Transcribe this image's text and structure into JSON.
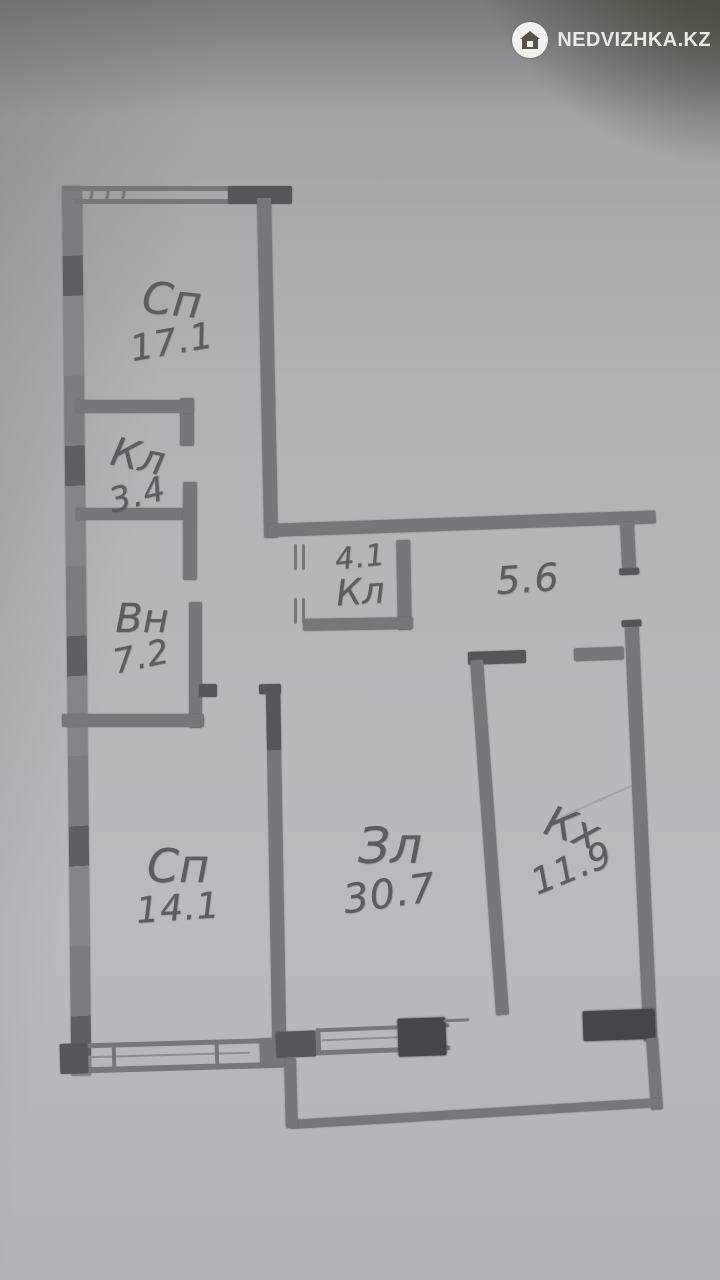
{
  "watermark": {
    "brand": "NEDVIZHKA.KZ",
    "icon": "house-in-circle"
  },
  "floorplan": {
    "type": "hand-drawn apartment floor plan (pencil sketch photo)",
    "rooms": [
      {
        "key": "bedroom-top",
        "abbr": "Сп",
        "area": "17.1"
      },
      {
        "key": "closet-small",
        "abbr": "Кл",
        "area": "3.4"
      },
      {
        "key": "bathroom",
        "abbr": "Вн",
        "area": "7.2"
      },
      {
        "key": "closet-hall",
        "abbr": "Кл",
        "area": "4.1"
      },
      {
        "key": "hallway",
        "abbr": "",
        "area": "5.6"
      },
      {
        "key": "bedroom-left",
        "abbr": "Сп",
        "area": "14.1"
      },
      {
        "key": "living-room",
        "abbr": "Зл",
        "area": "30.7"
      },
      {
        "key": "kitchen",
        "abbr": "Кх",
        "area": "11.9"
      }
    ]
  },
  "colors": {
    "paper": "#b2b2b6",
    "pencil": "#76767c",
    "pencil_dark": "#55555b",
    "pencil_darkest": "#45454b",
    "watermark_bg": "#514e46",
    "watermark_text": "#ece9e4"
  }
}
